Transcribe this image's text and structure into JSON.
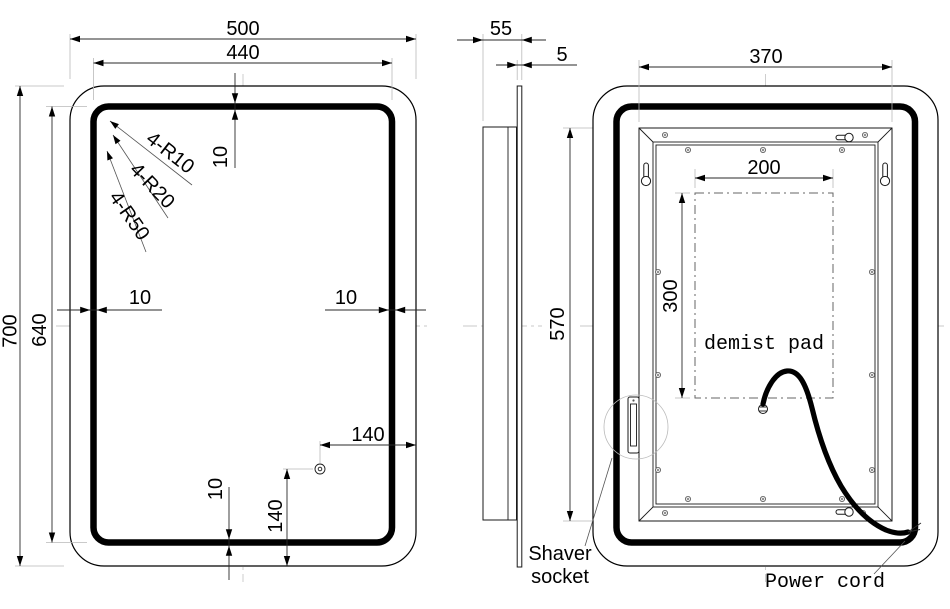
{
  "front": {
    "width": "500",
    "led_width": "440",
    "height": "700",
    "led_height": "640",
    "band_top": "10",
    "band_left": "10",
    "band_right": "10",
    "band_bottom": "10",
    "sensor_from_right": "140",
    "sensor_from_bottom": "140",
    "radius_callout_1": "4-R10",
    "radius_callout_2": "4-R20",
    "radius_callout_3": "4-R50"
  },
  "side": {
    "depth": "55",
    "glass_thickness": "5"
  },
  "back": {
    "frame_width": "370",
    "frame_height": "570",
    "pad_width": "200",
    "pad_height": "300",
    "demist_label": "demist pad",
    "shaver_label_line1": "Shaver",
    "shaver_label_line2": "socket",
    "power_cord_label": "Power cord"
  },
  "colors": {
    "paper": "#ffffff",
    "main_line": "#000000",
    "aux_line": "#b9b9b9"
  }
}
